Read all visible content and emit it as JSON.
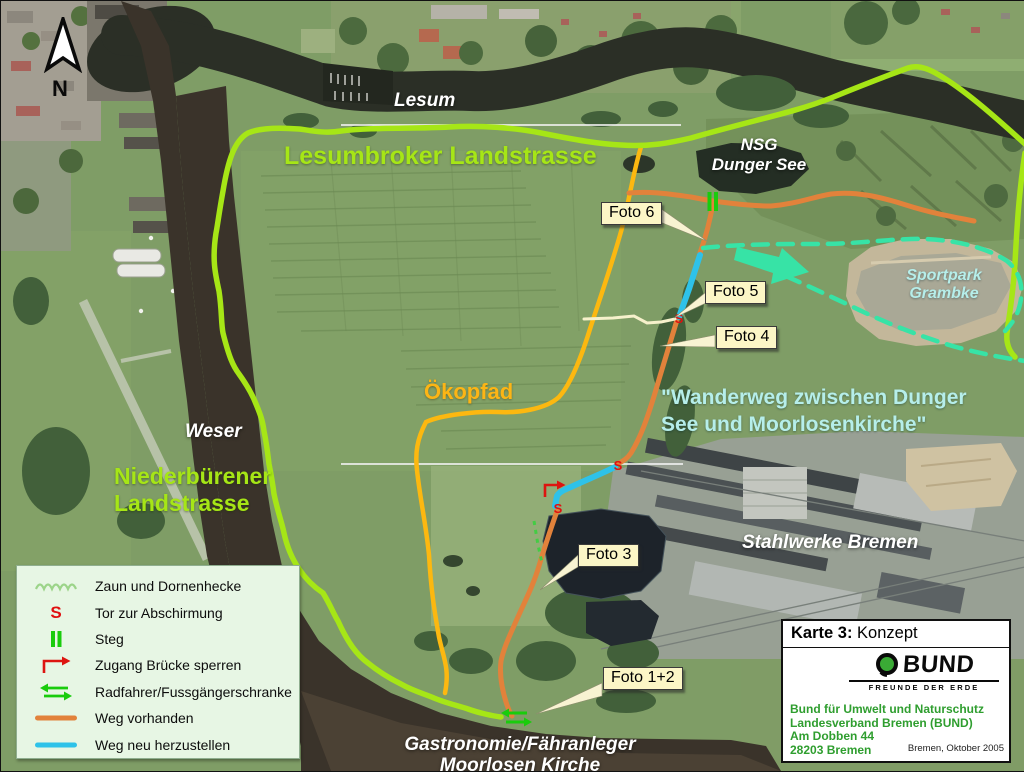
{
  "compass": {
    "label": "N"
  },
  "map_labels": {
    "lesum": "Lesum",
    "lesumbroker": "Lesumbroker Landstrasse",
    "nsg_line1": "NSG",
    "nsg_line2": "Dunger See",
    "sportpark_line1": "Sportpark",
    "sportpark_line2": "Grambke",
    "wanderweg_line1": "\"Wanderweg zwischen Dunger",
    "wanderweg_line2": "See und Moorlosenkirche\"",
    "oekopfad": "Ökopfad",
    "weser": "Weser",
    "niederbuerener_line1": "Niederbürener",
    "niederbuerener_line2": "Landstrasse",
    "stahlwerke": "Stahlwerke Bremen",
    "gastronomie_line1": "Gastronomie/Fähranleger",
    "gastronomie_line2": "Moorlosen Kirche"
  },
  "photos": {
    "foto6": "Foto 6",
    "foto5": "Foto 5",
    "foto4": "Foto 4",
    "foto3": "Foto 3",
    "foto12": "Foto 1+2"
  },
  "markers": {
    "gate_glyph": "S"
  },
  "legend": {
    "items": [
      {
        "symbol": "fence-hedge-icon",
        "label": "Zaun und Dornenhecke"
      },
      {
        "symbol": "gate-s-icon",
        "label": "Tor zur Abschirmung"
      },
      {
        "symbol": "footbridge-icon",
        "label": "Steg"
      },
      {
        "symbol": "block-bridge-icon",
        "label": "Zugang Brücke sperren"
      },
      {
        "symbol": "barrier-arrows-icon",
        "label": "Radfahrer/Fussgängerschranke"
      },
      {
        "symbol": "existing-path-icon",
        "label": "Weg vorhanden"
      },
      {
        "symbol": "new-path-icon",
        "label": "Weg neu herzustellen"
      }
    ]
  },
  "map_card": {
    "title_bold": "Karte 3:",
    "title_rest": " Konzept",
    "logo_text": "BUND",
    "logo_subtitle": "FREUNDE DER ERDE",
    "address_line1": "Bund für Umwelt und Naturschutz",
    "address_line2": "Landesverband Bremen (BUND)",
    "address_line3": "Am Dobben 44",
    "address_line4": "28203 Bremen",
    "date_note": "Bremen, Oktober 2005"
  },
  "colors": {
    "road_route": "#a6e616",
    "path_existing": "#e2823b",
    "path_new": "#2ec2e9",
    "oekopfad_path": "#fcb810",
    "planned_mint": "#37e3a6",
    "marker_green": "#19cc0c",
    "marker_red": "#e01010",
    "label_cyan": "#b6eeea",
    "legend_bg": "#e7f6e4"
  }
}
